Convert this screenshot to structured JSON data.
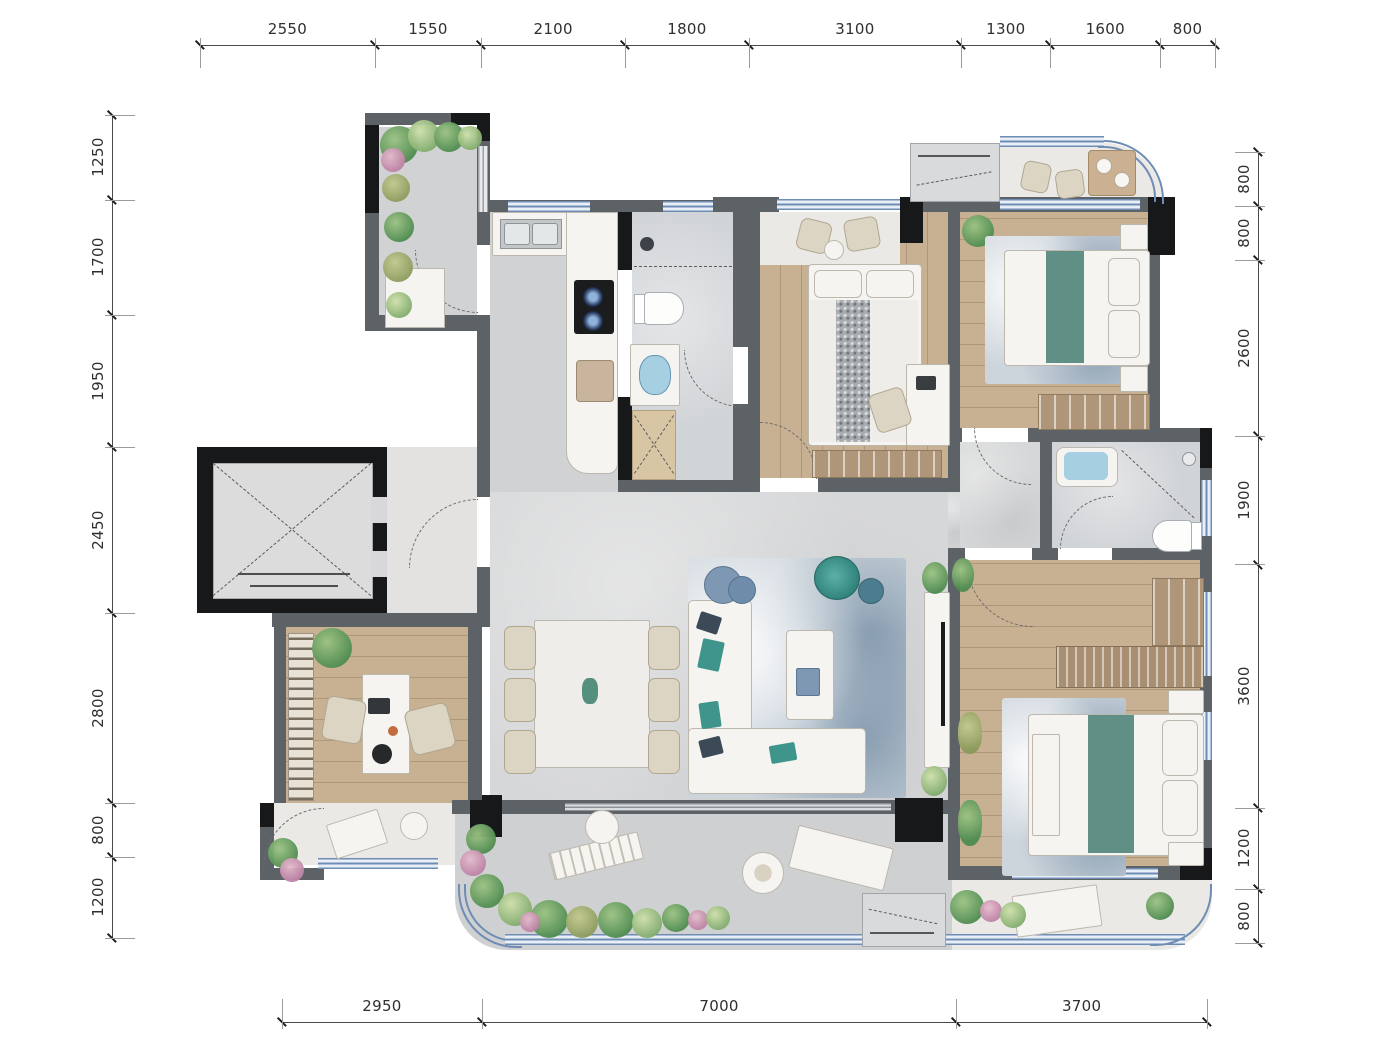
{
  "dimensions": {
    "top": [
      2550,
      1550,
      2100,
      1800,
      3100,
      1300,
      1600,
      800
    ],
    "left": [
      1250,
      1700,
      1950,
      2450,
      2800,
      800,
      1200
    ],
    "right": [
      800,
      800,
      2600,
      1900,
      3600,
      1200,
      800
    ],
    "bottom": [
      2950,
      7000,
      3700
    ]
  },
  "colors": {
    "wall_gray": "#5d6266",
    "wall_black": "#17181a",
    "wood_floor": "#c8b193",
    "tile_floor": "#d6d7d8",
    "marble_floor": "#ebe9e6",
    "window_line": "#6f8db4",
    "window_glass": "#e9eff6",
    "bed_runner_teal": "#5f8f85",
    "sofa_accent_teal": "#3f948b",
    "rug_blue_gray": "#b6c2cd",
    "plant_green": "#4f8c50",
    "dim_text": "#2f2f2f"
  }
}
